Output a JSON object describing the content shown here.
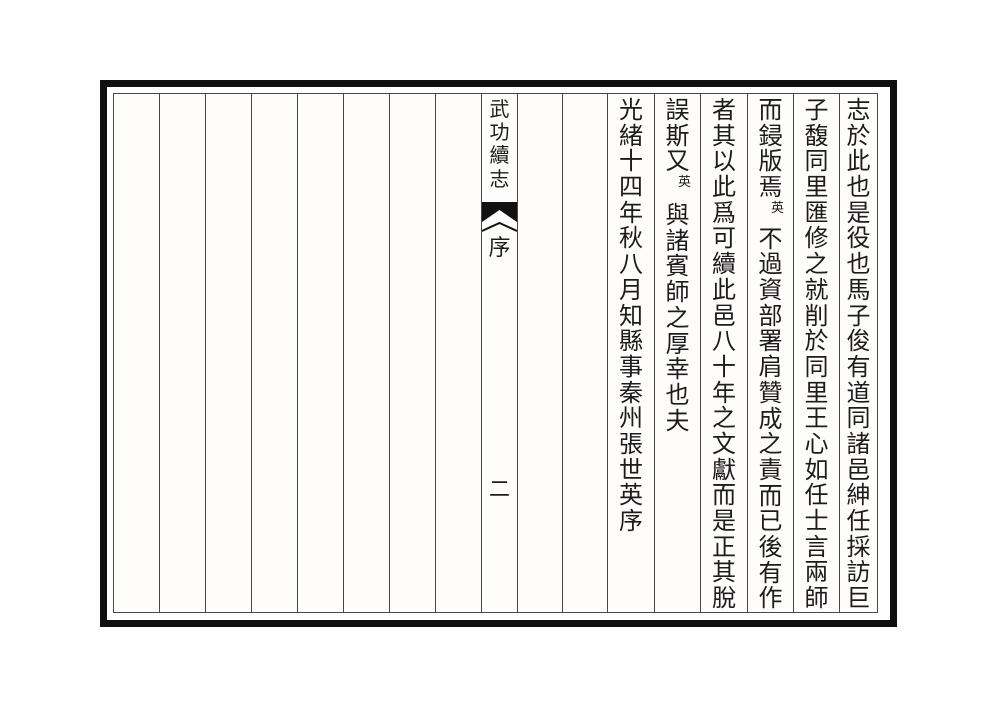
{
  "book": {
    "title": "武功續志",
    "section": "序",
    "page_number": "二"
  },
  "banxin_title": {
    "segments": [
      {
        "text": "武功續志"
      }
    ]
  },
  "columns_right_to_left": [
    {
      "segments": [
        {
          "text": "志於此也是役也馬子俊有道同諸邑紳任採訪巨"
        }
      ]
    },
    {
      "segments": [
        {
          "text": "子馥同里匯修之就削於同里王心如任士言兩師"
        }
      ]
    },
    {
      "segments": [
        {
          "text": "而鋟版焉"
        },
        {
          "text": "英",
          "small": true
        },
        {
          "text": "不過資部署肩贊成之責而已後有作"
        }
      ]
    },
    {
      "segments": [
        {
          "text": "者其以此爲可續此邑八十年之文獻而是正其脫"
        }
      ]
    },
    {
      "segments": [
        {
          "text": "誤斯又"
        },
        {
          "text": "英",
          "small": true
        },
        {
          "text": "與諸賓師之厚幸也夫"
        }
      ]
    },
    {
      "segments": [
        {
          "text": "光緒十四年秋八月知縣事秦州張世英序"
        }
      ]
    }
  ],
  "colors": {
    "paper": "#ffffff",
    "ink": "#1c1c1c",
    "rule_line": "#474747",
    "border": "#0f0f0f",
    "fishtail": "#111111"
  }
}
